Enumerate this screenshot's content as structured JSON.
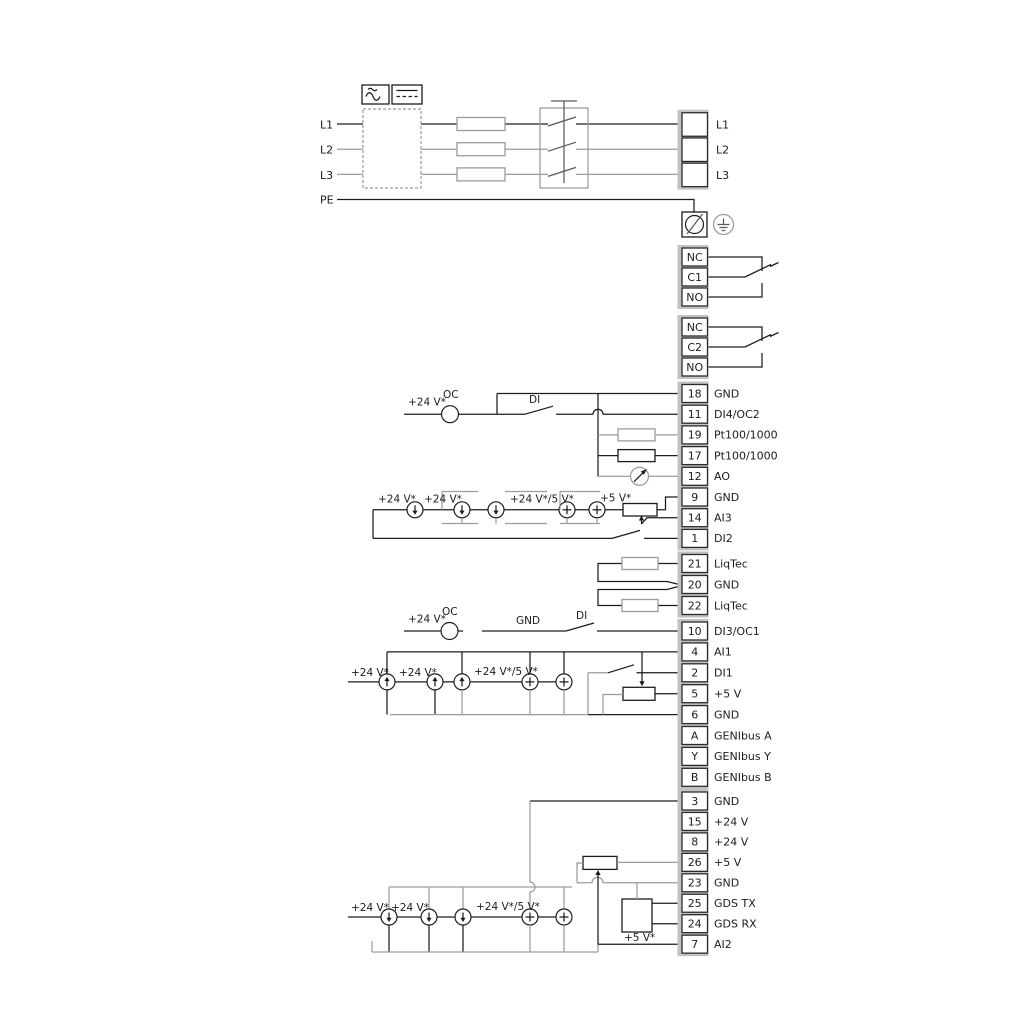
{
  "power": {
    "inputs": [
      "L1",
      "L2",
      "L3",
      "PE"
    ],
    "outputs": [
      "L1",
      "L2",
      "L3"
    ]
  },
  "relay1": [
    "NC",
    "C1",
    "NO"
  ],
  "relay2": [
    "NC",
    "C2",
    "NO"
  ],
  "strips": {
    "io1": [
      {
        "num": "18",
        "label": "GND"
      },
      {
        "num": "11",
        "label": "DI4/OC2"
      },
      {
        "num": "19",
        "label": "Pt100/1000"
      },
      {
        "num": "17",
        "label": "Pt100/1000"
      },
      {
        "num": "12",
        "label": "AO"
      },
      {
        "num": "9",
        "label": "GND"
      },
      {
        "num": "14",
        "label": "AI3"
      },
      {
        "num": "1",
        "label": "DI2"
      }
    ],
    "liqtec": [
      {
        "num": "21",
        "label": "LiqTec"
      },
      {
        "num": "20",
        "label": "GND"
      },
      {
        "num": "22",
        "label": "LiqTec"
      }
    ],
    "io2": [
      {
        "num": "10",
        "label": "DI3/OC1"
      },
      {
        "num": "4",
        "label": "AI1"
      },
      {
        "num": "2",
        "label": "DI1"
      },
      {
        "num": "5",
        "label": "+5 V"
      },
      {
        "num": "6",
        "label": "GND"
      },
      {
        "num": "A",
        "label": "GENIbus A"
      },
      {
        "num": "Y",
        "label": "GENIbus Y"
      },
      {
        "num": "B",
        "label": "GENIbus B"
      }
    ],
    "io3": [
      {
        "num": "3",
        "label": "GND"
      },
      {
        "num": "15",
        "label": "+24 V"
      },
      {
        "num": "8",
        "label": "+24 V"
      },
      {
        "num": "26",
        "label": "+5 V"
      },
      {
        "num": "23",
        "label": "GND"
      },
      {
        "num": "25",
        "label": "GDS TX"
      },
      {
        "num": "24",
        "label": "GDS RX"
      },
      {
        "num": "7",
        "label": "AI2"
      }
    ]
  },
  "annotations": {
    "v24": "+24 V*",
    "v24_5": "+24 V*/5 V*",
    "v5": "+5 V*",
    "oc": "OC",
    "di": "DI",
    "gnd": "GND"
  },
  "colors": {
    "line": "#1c1c1c",
    "muted": "#9c9c9c",
    "strip_frame": "#c2c2c2"
  }
}
